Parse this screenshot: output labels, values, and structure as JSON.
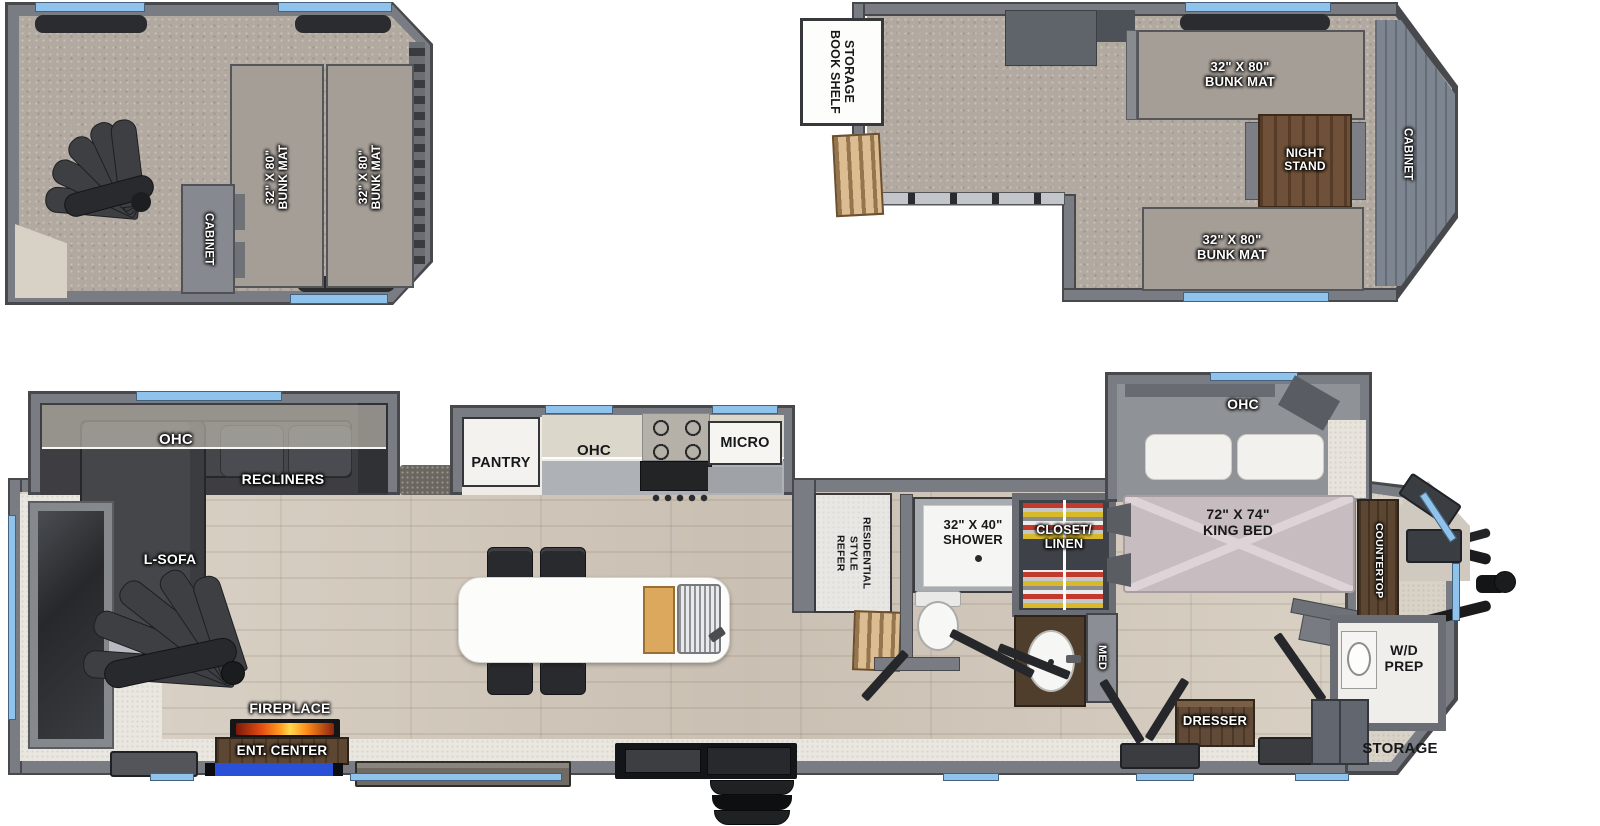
{
  "colors": {
    "wall": "#797c82",
    "wall_outline": "#47494d",
    "window_blue": "#8fc3ec",
    "carpet": "#b2a9a0",
    "wood_floor": "#d4cabc",
    "furniture_dark": "#3c3d41",
    "cabinet_wood": "#5d4733",
    "flame_orange": "#ff9b1f",
    "ent_mat_blue": "#2b50d8",
    "label_white": "#ffffff",
    "label_black": "#17181a"
  },
  "loft_left": {
    "bunk_mat_1": "32\" X 80\"\nBUNK MAT",
    "bunk_mat_2": "32\" X 80\"\nBUNK MAT",
    "cabinet": "CABINET"
  },
  "loft_right": {
    "book_shelf": "BOOK SHELF\nSTORAGE",
    "bunk_mat_top": "32\" X 80\"\nBUNK MAT",
    "night_stand": "NIGHT\nSTAND",
    "bunk_mat_bottom": "32\" X 80\"\nBUNK MAT",
    "cabinet": "CABINET"
  },
  "main_floor": {
    "living": {
      "ohc": "OHC",
      "recliners": "RECLINERS",
      "l_sofa": "L-SOFA",
      "fireplace": "FIREPLACE",
      "ent_center": "ENT. CENTER"
    },
    "kitchen": {
      "pantry": "PANTRY",
      "ohc": "OHC",
      "micro": "MICRO"
    },
    "utility": {
      "refer": "RESIDENTIAL\nSTYLE\nREFER"
    },
    "bath": {
      "shower": "32\" X 40\"\nSHOWER",
      "closet": "CLOSET/\nLINEN",
      "med": "MED"
    },
    "bedroom": {
      "ohc": "OHC",
      "king_bed": "72\" X 74\"\nKING BED",
      "dresser": "DRESSER",
      "countertop": "COUNTERTOP",
      "wd_prep": "W/D\nPREP",
      "storage": "STORAGE"
    }
  }
}
